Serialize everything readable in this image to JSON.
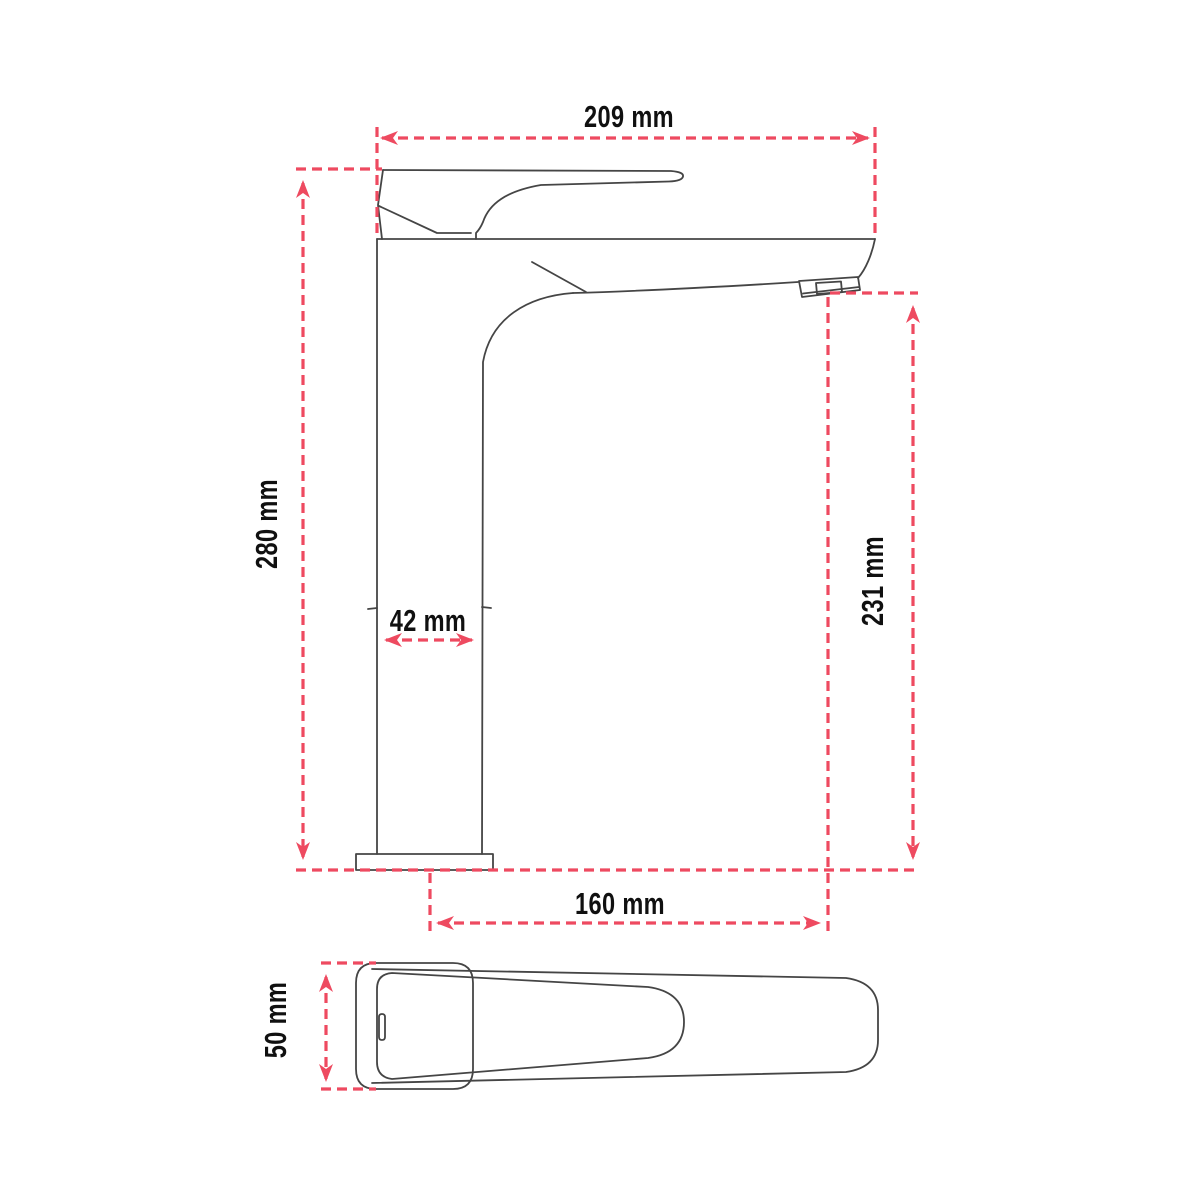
{
  "drawing": {
    "title": "basin mixer tap dimension drawing",
    "accent_color": "#ee4a60",
    "line_color": "#454545",
    "views": {
      "side_view": "faucet side elevation",
      "top_view": "faucet top view"
    },
    "dimensions": {
      "top_width": {
        "label": "209 mm"
      },
      "overall_height": {
        "label": "280 mm"
      },
      "body_width": {
        "label": "42 mm"
      },
      "spout_height": {
        "label": "231 mm"
      },
      "base_to_spout_reach": {
        "label": "160 mm"
      },
      "handle_width": {
        "label": "50 mm"
      }
    }
  }
}
